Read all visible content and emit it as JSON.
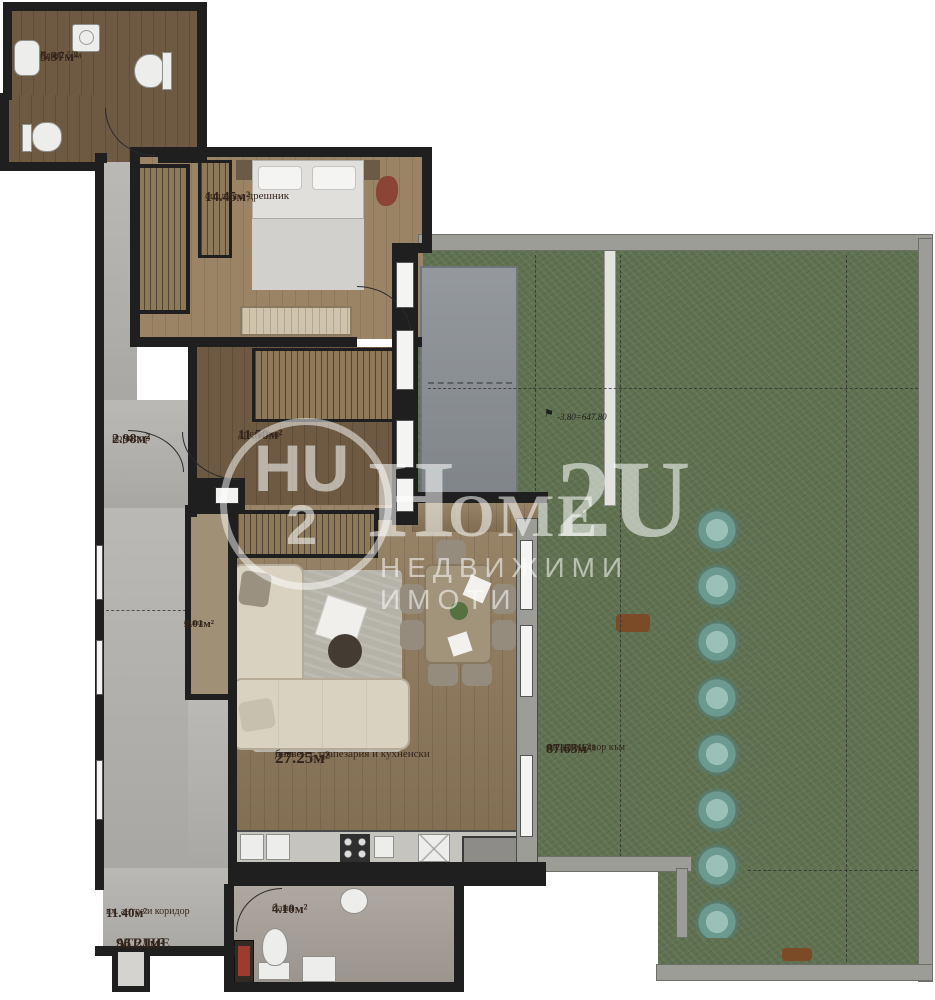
{
  "watermark": {
    "logo_letters": "HU",
    "logo_digit": "2",
    "brand_h": "H",
    "brand_ome": "OME",
    "brand_2u": "2U",
    "tagline": "НЕДВИЖИМИ ИМОТИ"
  },
  "rooms": {
    "bath_top": {
      "height_note": "Нсв=2.50м",
      "name": "баня",
      "area": "5.37м²"
    },
    "bedroom": {
      "name": "спалня с дрешник",
      "area": "14.45м²"
    },
    "corridor": {
      "name": "коридор",
      "area": "2.98м²"
    },
    "walkin": {
      "name": "дрешник",
      "area": "11.50м²"
    },
    "storage": {
      "name": "склад",
      "area": "2.01м²"
    },
    "living": {
      "name_line1": "дневен с трапезария и кухненски",
      "name_line2": "бокс",
      "area": "27.25м²"
    },
    "entry": {
      "name": "вх. антре и коридор",
      "area": "11.40м²"
    },
    "atelier": {
      "name": "АТЕЛИЕ",
      "area": "96.21м²"
    },
    "bath_bottom": {
      "name": "баня",
      "area": "4.10м²"
    },
    "garden": {
      "name_line1": "озеленен двор към",
      "name_line2": "АТЕЛИЕ 1",
      "area": "87.63м²"
    }
  },
  "annotations": {
    "elevation_flag": "⚑",
    "elevation": "-3.80=647.80"
  },
  "colors": {
    "wall": "#1f1f1f",
    "grass": "#5f7150",
    "hedge": "#6d9e96",
    "wood": "#8f7a5b",
    "label": "#33241b"
  }
}
